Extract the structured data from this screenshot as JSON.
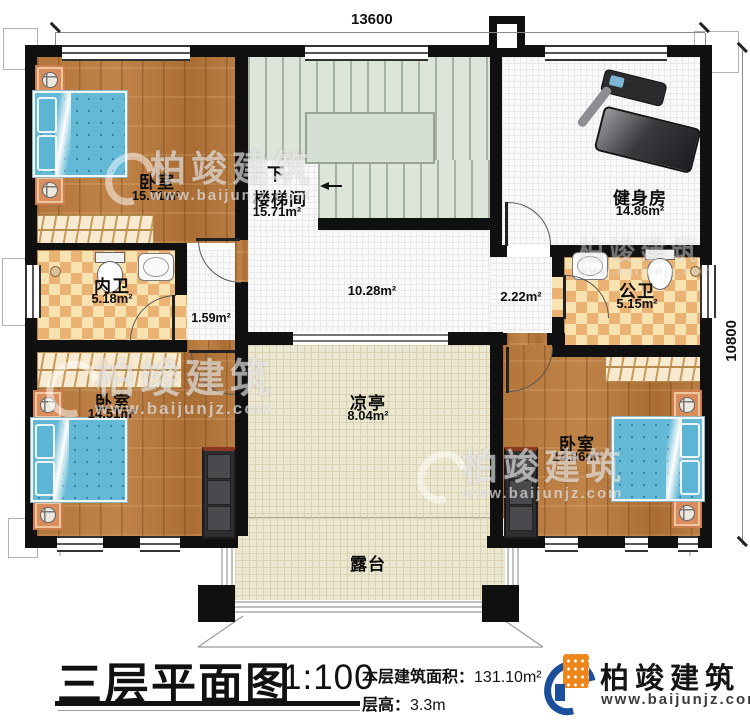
{
  "meta": {
    "title": "三层平面图",
    "scale": "1:100",
    "area_label": "本层建筑面积：",
    "area_value": "131.10m²",
    "height_label": "层高：",
    "height_value": "3.3m"
  },
  "logo": {
    "name": "柏竣建筑",
    "url": "www.baijunjz.com"
  },
  "watermark": {
    "name": "柏竣建筑",
    "url": "www.baijunjz.com"
  },
  "dimensions": {
    "top": "13600",
    "right": "10800"
  },
  "rooms": {
    "bedroom_tl": {
      "name": "卧室",
      "area": "15.71m²"
    },
    "stairwell": {
      "name": "楼梯间",
      "area": "15.71m²",
      "direction": "下"
    },
    "gym": {
      "name": "健身房",
      "area": "14.86m²"
    },
    "bath_inner": {
      "name": "内卫",
      "area": "5.18m²"
    },
    "bath_public": {
      "name": "公卫",
      "area": "5.15m²"
    },
    "bedroom_bl": {
      "name": "卧室",
      "area": "14.51m²"
    },
    "bedroom_br": {
      "name": "卧室",
      "area": "14.86m²"
    },
    "pavilion": {
      "name": "凉亭",
      "area": "8.04m²"
    },
    "terrace": {
      "name": "露台"
    },
    "hall_area": "10.28m²",
    "corridor_left_area": "1.59m²",
    "corridor_right_area": "2.22m²"
  },
  "colors": {
    "wall": "#101010",
    "wood": "#b5793c",
    "tile_dark": "#eab373",
    "tile_light": "#f8e2b0",
    "bed_blue": "#63b9d6",
    "cream": "#ece7d0",
    "logo_blue": "#1b4f9c",
    "logo_orange": "#f08519"
  }
}
